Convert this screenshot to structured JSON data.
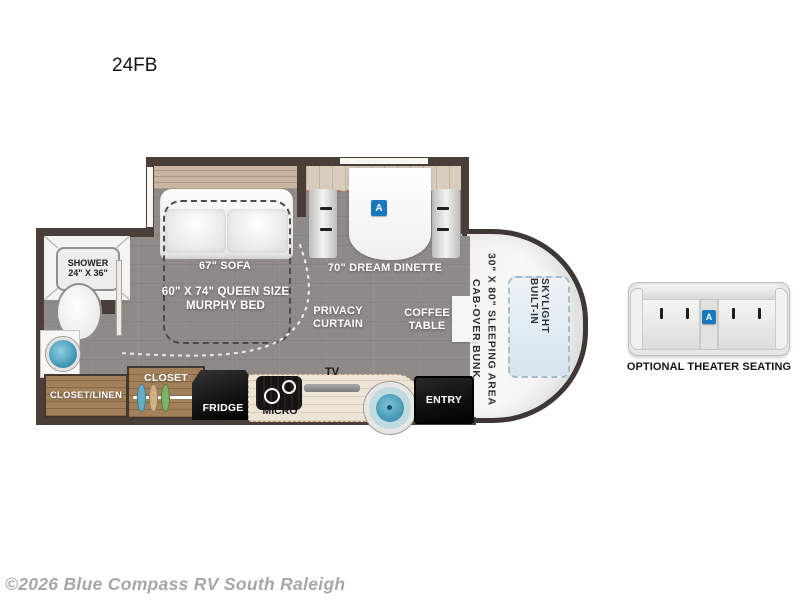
{
  "title": "24FB",
  "copyright": "©2026 Blue Compass RV South Raleigh",
  "colors": {
    "wall": "#4a3e39",
    "floor": "#8d8a87",
    "wood": "#a28059",
    "accent_blue": "#1878bd",
    "skylight_blue": "#d5e4ef",
    "sink_teal": "#3d92ae",
    "appliance_black": "#141414"
  },
  "rooms": {
    "shower_line1": "SHOWER",
    "shower_line2": "24\" X 36\"",
    "sofa": "67\" SOFA",
    "murphy_line1": "60\" X 74\" QUEEN SIZE",
    "murphy_line2": "MURPHY BED",
    "dinette": "70\" DREAM DINETTE",
    "privacy_line1": "PRIVACY",
    "privacy_line2": "CURTAIN",
    "coffee_line1": "COFFEE",
    "coffee_line2": "TABLE",
    "closet": "CLOSET",
    "closet_linen": "CLOSET/LINEN",
    "fridge": "FRIDGE",
    "micro": "MICRO",
    "tv": "TV",
    "entry": "ENTRY",
    "bunk_line1": "CAB-OVER BUNK",
    "bunk_line2": "30\" X 80\" SLEEPING AREA",
    "skylight": "BUILT-IN SKYLIGHT",
    "badge": "A"
  },
  "theater": {
    "caption": "OPTIONAL THEATER SEATING",
    "badge": "A"
  },
  "icons": {
    "hangers": [
      "hanger-blue",
      "hanger-tan",
      "hanger-green"
    ]
  }
}
